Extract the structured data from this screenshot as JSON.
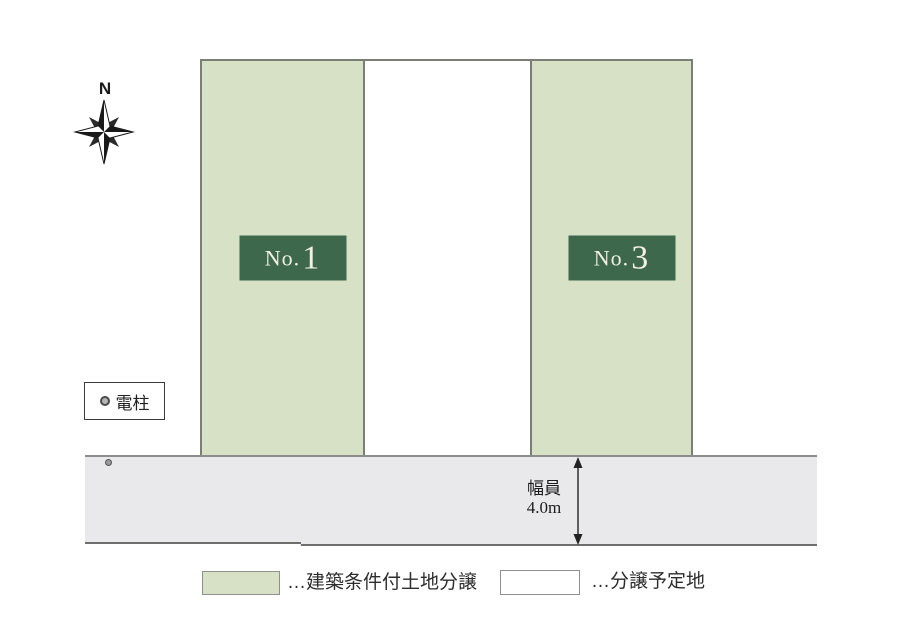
{
  "compass": {
    "label": "N"
  },
  "plots": [
    {
      "name": "plot-1",
      "fill": "green",
      "label_prefix": "No.",
      "label_number": "1"
    },
    {
      "name": "plot-middle",
      "fill": "white"
    },
    {
      "name": "plot-3",
      "fill": "green",
      "label_prefix": "No.",
      "label_number": "3"
    }
  ],
  "pole": {
    "label": "電柱"
  },
  "road": {
    "width_label_line1": "幅員",
    "width_label_line2": "4.0m"
  },
  "legend": {
    "items": [
      {
        "swatch": "green",
        "label": "…建築条件付土地分譲"
      },
      {
        "swatch": "white",
        "label": "…分譲予定地"
      }
    ]
  },
  "colors": {
    "plot_green": "#d6e1c6",
    "label_green": "#3e684c",
    "label_text": "#f2efe3",
    "road_gray": "#e9e9eb",
    "border_gray": "#7b7e75",
    "line_gray": "#6e6e6e",
    "road_border": "#8c8c8c",
    "ink": "#222222"
  }
}
